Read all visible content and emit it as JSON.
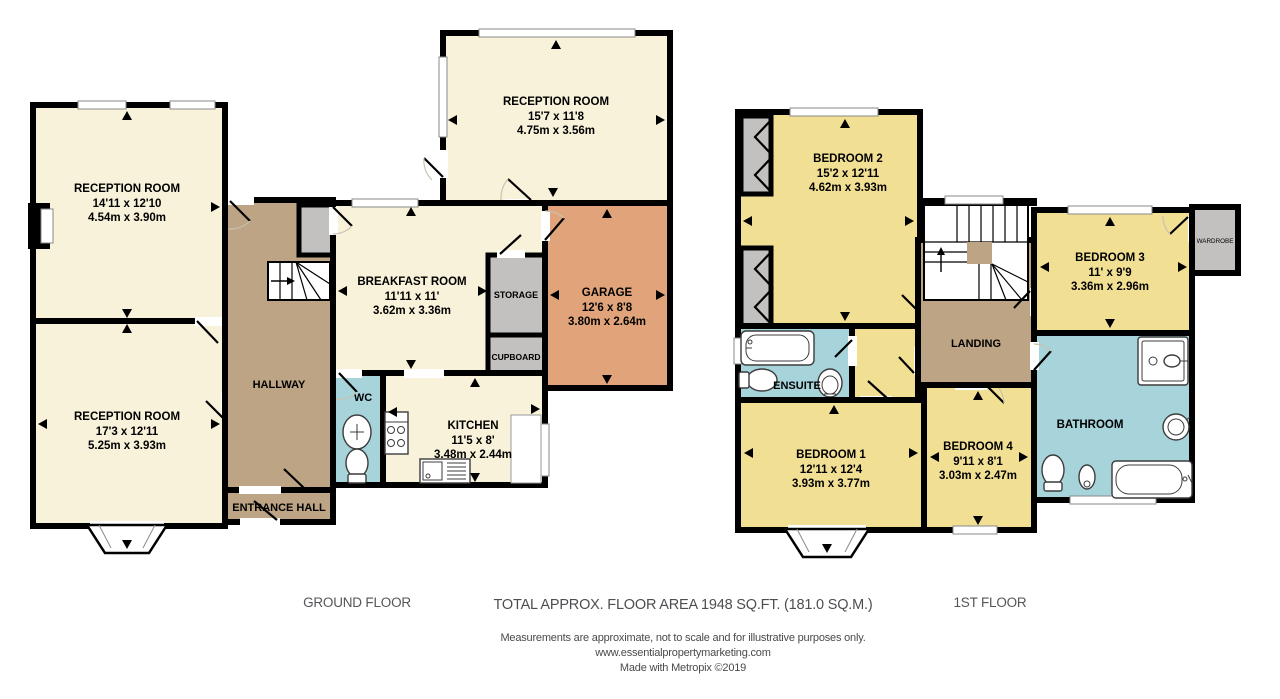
{
  "colors": {
    "room_cream": "#F8F2DA",
    "room_yellow": "#F1DF94",
    "hall_tan": "#BCA484",
    "garage_orange": "#E1A47A",
    "wet_blue": "#A7D3DB",
    "closet_gray": "#C2C1BF",
    "wall_black": "#000000"
  },
  "ground_floor": {
    "caption": "GROUND FLOOR",
    "rooms": {
      "reception_top_left": {
        "name": "RECEPTION ROOM",
        "imperial": "14'11 x 12'10",
        "metric": "4.54m x 3.90m"
      },
      "reception_bottom_left": {
        "name": "RECEPTION ROOM",
        "imperial": "17'3 x 12'11",
        "metric": "5.25m x 3.93m"
      },
      "reception_top_middle": {
        "name": "RECEPTION ROOM",
        "imperial": "15'7 x 11'8",
        "metric": "4.75m x 3.56m"
      },
      "breakfast_room": {
        "name": "BREAKFAST ROOM",
        "imperial": "11'11 x 11'",
        "metric": "3.62m x 3.36m"
      },
      "kitchen": {
        "name": "KITCHEN",
        "imperial": "11'5 x 8'",
        "metric": "3.48m x 2.44m"
      },
      "garage": {
        "name": "GARAGE",
        "imperial": "12'6 x 8'8",
        "metric": "3.80m x 2.64m"
      },
      "hallway": {
        "name": "HALLWAY"
      },
      "entrance_hall": {
        "name": "ENTRANCE HALL"
      },
      "wc": {
        "name": "WC"
      },
      "storage": {
        "name": "STORAGE"
      },
      "cupboard": {
        "name": "CUPBOARD"
      }
    }
  },
  "first_floor": {
    "caption": "1ST FLOOR",
    "rooms": {
      "bedroom_2": {
        "name": "BEDROOM 2",
        "imperial": "15'2 x 12'11",
        "metric": "4.62m x 3.93m"
      },
      "bedroom_3": {
        "name": "BEDROOM 3",
        "imperial": "11' x 9'9",
        "metric": "3.36m x 2.96m"
      },
      "bedroom_1": {
        "name": "BEDROOM 1",
        "imperial": "12'11 x 12'4",
        "metric": "3.93m x 3.77m"
      },
      "bedroom_4": {
        "name": "BEDROOM 4",
        "imperial": "9'11 x 8'1",
        "metric": "3.03m x 2.47m"
      },
      "landing": {
        "name": "LANDING"
      },
      "ensuite": {
        "name": "ENSUITE"
      },
      "bathroom": {
        "name": "BATHROOM"
      },
      "wardrobe": {
        "name": "WARDROBE"
      }
    }
  },
  "footer": {
    "total_area": "TOTAL APPROX. FLOOR AREA 1948 SQ.FT. (181.0 SQ.M.)",
    "disclaimer": "Measurements are approximate, not to scale and for illustrative purposes only.",
    "website": "www.essentialpropertymarketing.com",
    "credit": "Made with Metropix ©2019"
  }
}
